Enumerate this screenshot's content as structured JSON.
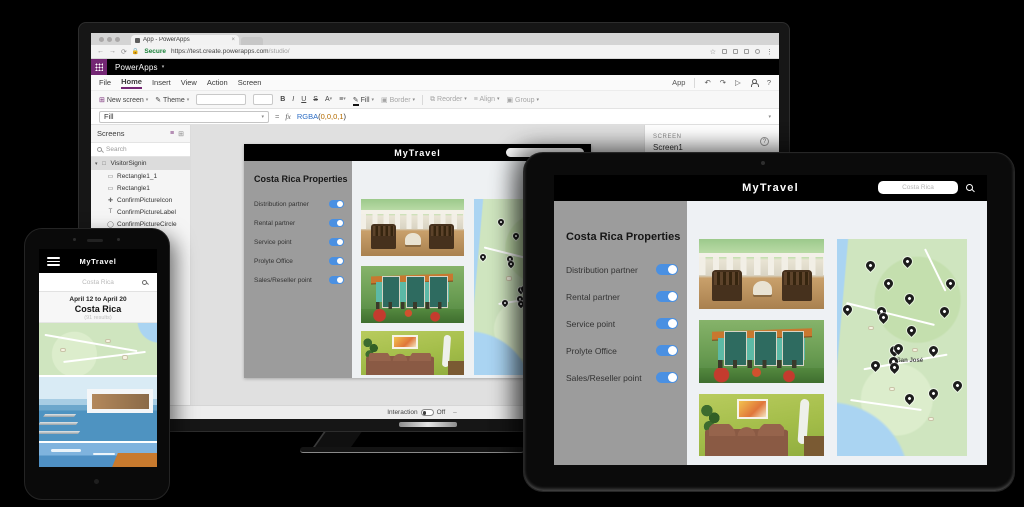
{
  "browser": {
    "tab_title": "App - PowerApps",
    "close_tab": "×",
    "secure_label": "Secure",
    "url_main": "https://test.create.powerapps.com",
    "url_path": "/studio/"
  },
  "powerapps": {
    "brand": "PowerApps",
    "menu": [
      "File",
      "Home",
      "Insert",
      "View",
      "Action",
      "Screen"
    ],
    "app_label": "App",
    "toolbar": {
      "new_screen": "New screen",
      "theme": "Theme",
      "bold": "B",
      "italic": "I",
      "underline": "U",
      "strike": "S",
      "font_color": "A",
      "fill": "Fill",
      "border": "Border",
      "reorder": "Reorder",
      "align": "Align",
      "group": "Group"
    },
    "formula": {
      "property": "Fill",
      "equals": "=",
      "fx": "fx",
      "func": "RGBA",
      "lparen": "(",
      "args": "0,0,0,1",
      "rparen": ")"
    },
    "screens_panel": {
      "title": "Screens",
      "search_placeholder": "Search",
      "items": [
        "VisitorSignin",
        "Rectangle1_1",
        "Rectangle1",
        "ConfirmPictureIcon",
        "ConfirmPictureLabel",
        "ConfirmPictureCircle"
      ]
    },
    "right_panel": {
      "section": "SCREEN",
      "value": "Screen1"
    },
    "status_bar": {
      "screen": "Screen1",
      "interaction_label": "Interaction",
      "interaction_state": "Off",
      "zoom_minus": "–"
    }
  },
  "app": {
    "title": "MyTravel",
    "search_placeholder": "Costa Rica",
    "heading": "Costa Rica Properties",
    "toggles": [
      "Distribution partner",
      "Rental partner",
      "Service point",
      "Prolyte Office",
      "Sales/Reseller point"
    ],
    "map_label": "San José",
    "accent_color": "#4a90e2"
  },
  "phone": {
    "title": "MyTravel",
    "search_placeholder": "Costa Rica",
    "date_range": "April 12 to April 20",
    "location": "Costa Rica",
    "results": "(91 results)"
  },
  "map_pins": [
    [
      25,
      14
    ],
    [
      54,
      12
    ],
    [
      39,
      22
    ],
    [
      87,
      22
    ],
    [
      8,
      34
    ],
    [
      55,
      29
    ],
    [
      34,
      35
    ],
    [
      35,
      38
    ],
    [
      82,
      35
    ],
    [
      57,
      44
    ],
    [
      44,
      53
    ],
    [
      47,
      52
    ],
    [
      74,
      53
    ],
    [
      29,
      60
    ],
    [
      43,
      58
    ],
    [
      44,
      61
    ],
    [
      92,
      69
    ],
    [
      74,
      73
    ],
    [
      55,
      75
    ]
  ]
}
